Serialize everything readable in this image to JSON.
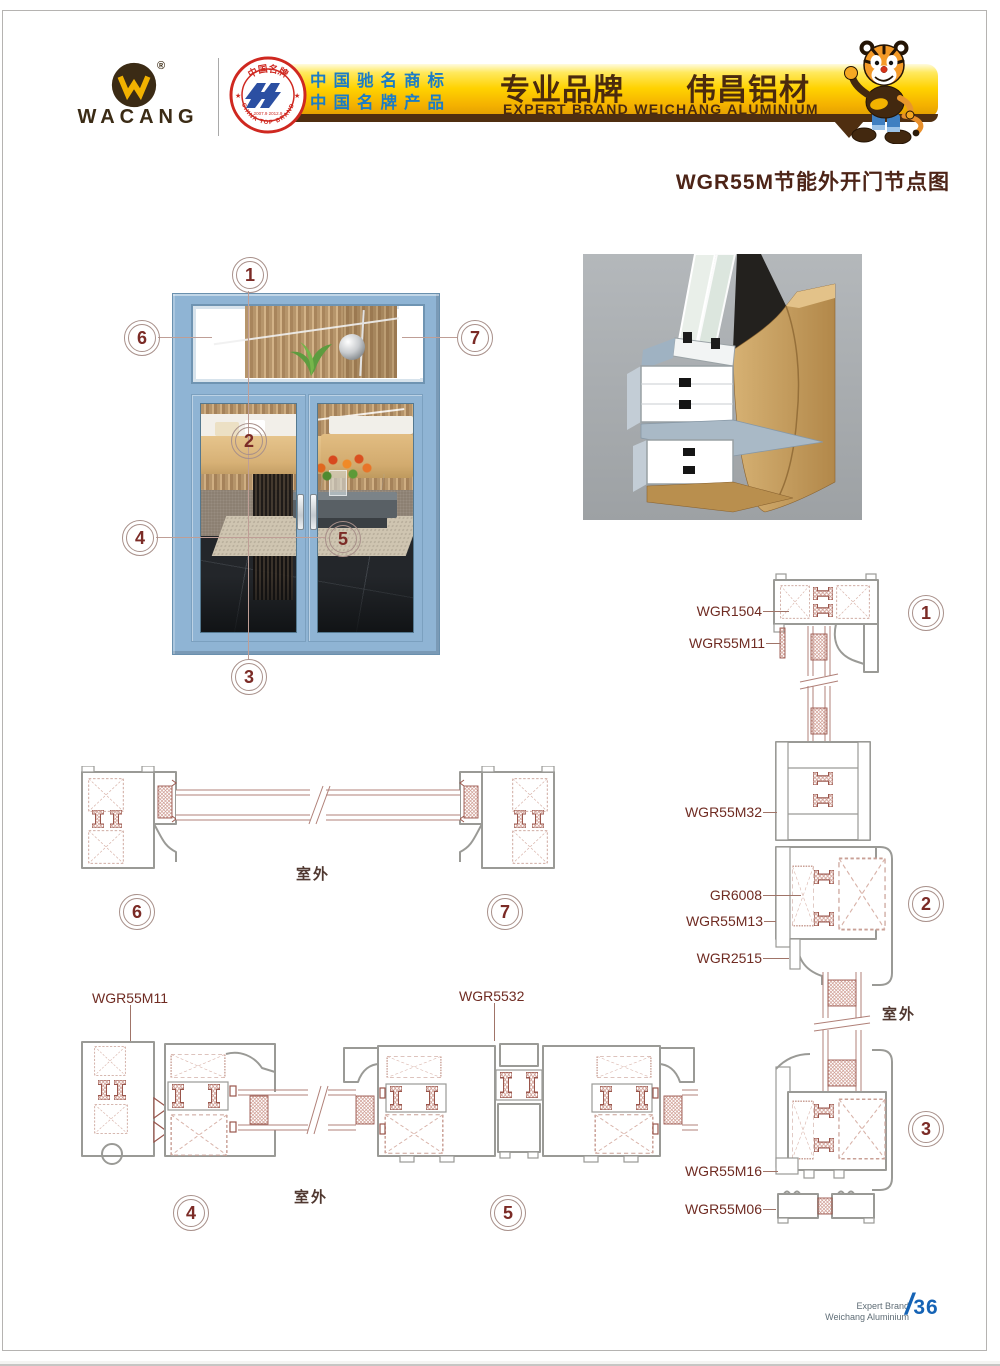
{
  "page": {
    "title": "WGR55M节能外开门节点图",
    "footer": {
      "brand_line1": "Expert Brand",
      "brand_line2": "Weichang Aluminium",
      "separator": "/",
      "page_number": "36"
    }
  },
  "header": {
    "logo": {
      "text": "WACANG",
      "registered": "®"
    },
    "badge": {
      "arc_top": "中国名牌",
      "arc_bottom": "CHINA TOP BRAND",
      "years": "2007.9  2012.9"
    },
    "banner": {
      "claim1": "中国驰名商标",
      "claim2": "中国名牌产品",
      "slogan_cn": "专业品牌　　伟昌铝材",
      "slogan_en": "EXPERT BRAND WEICHANG ALUMINIUM"
    }
  },
  "callouts": {
    "c1": "1",
    "c2": "2",
    "c3": "3",
    "c4": "4",
    "c5": "5",
    "c6": "6",
    "c7": "7"
  },
  "profile_labels": {
    "wgr1504": "WGR1504",
    "wgr55m11_right": "WGR55M11",
    "wgr55m32": "WGR55M32",
    "gr6008": "GR6008",
    "wgr55m13": "WGR55M13",
    "wgr2515": "WGR2515",
    "wgr55m16": "WGR55M16",
    "wgr55m06": "WGR55M06",
    "wgr55m11_left": "WGR55M11",
    "wgr5532": "WGR5532"
  },
  "outdoor_labels": {
    "transom_section": "室外",
    "door_section": "室外",
    "right_column": "室外"
  },
  "colors": {
    "banner_gold": "#ffd200",
    "brand_brown": "#4a2a0e",
    "claim_blue": "#1b7cc6",
    "maroon_text": "#6f2b22",
    "callout_number": "#7b2b26",
    "frame_blue": "#8fb4d4",
    "page_number_blue": "#1563b5"
  }
}
